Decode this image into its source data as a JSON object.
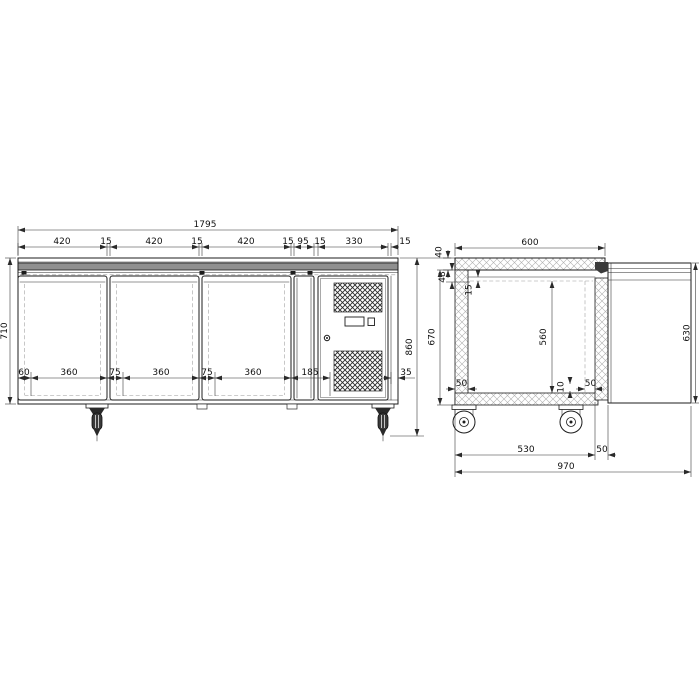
{
  "front": {
    "overall_width": "1795",
    "top_chain": [
      "420",
      "15",
      "420",
      "15",
      "420",
      "15",
      "95",
      "15",
      "330",
      "15"
    ],
    "height": "710",
    "overall_height": "860",
    "bottom_chain": [
      "60",
      "360",
      "75",
      "360",
      "75",
      "360",
      "185"
    ],
    "right_rail": "35"
  },
  "side": {
    "depth": "600",
    "top_thickness": "40",
    "top_inset": "48",
    "liner_gap": "15",
    "body_height": "670",
    "interior_height": "560",
    "door_height": "630",
    "left_wall": "50",
    "right_wall": "50",
    "bottom_step": "10",
    "base_depth": "530",
    "door_thickness": "50",
    "overall_depth": "970"
  }
}
